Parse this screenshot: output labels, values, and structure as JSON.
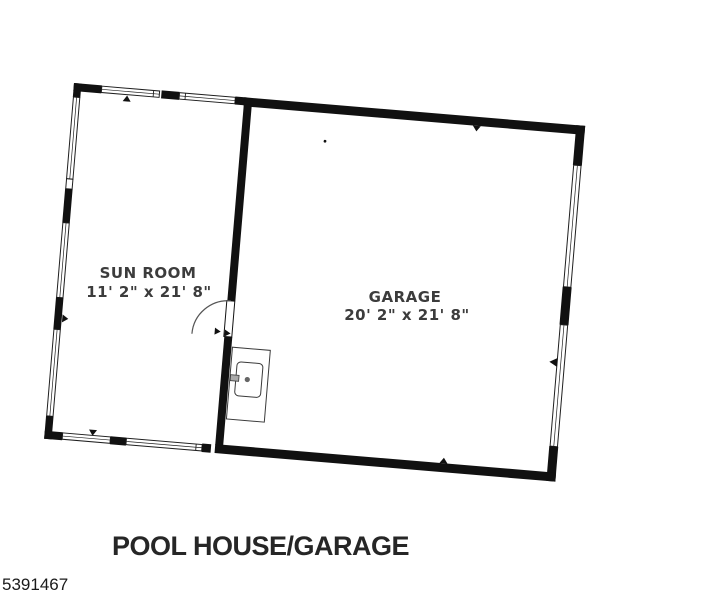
{
  "page": {
    "background_color": "#ffffff"
  },
  "floorplan": {
    "title": "POOL HOUSE/GARAGE",
    "listing_id": "5391467",
    "rooms": [
      {
        "name": "SUN ROOM",
        "dimensions": "11' 2\" x 21' 8\""
      },
      {
        "name": "GARAGE",
        "dimensions": "20' 2\" x 21' 8\""
      }
    ],
    "icons": {
      "door": "door-swing-icon",
      "window": "window-icon",
      "fixture": "utility-fixture-icon",
      "marker": "wall-marker-icon"
    },
    "colors": {
      "wall": "#111111",
      "window_outline": "#1f1f1f",
      "door_arc": "#555555",
      "fixture_outline": "#3a3a3a",
      "room_label": "#3c3c3c",
      "title_text": "#262626"
    }
  }
}
